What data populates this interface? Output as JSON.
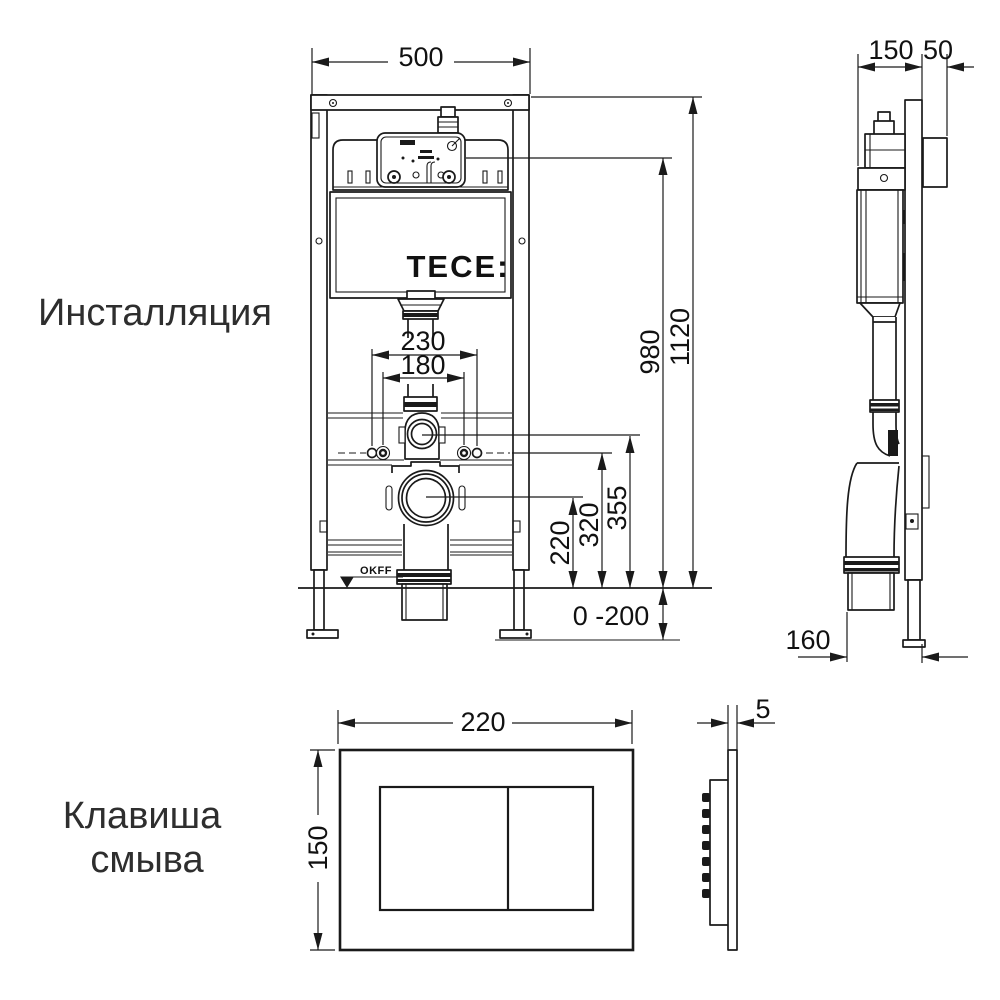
{
  "colors": {
    "background": "#ffffff",
    "line": "#1a1a1a",
    "label_text": "#2e2e2e"
  },
  "labels": {
    "installation": "Инсталляция",
    "flush_plate_line1": "Клавиша",
    "flush_plate_line2": "смыва"
  },
  "front_view": {
    "brand_logo": "TECE:",
    "floor_level_mark": "OKFF",
    "dimensions": {
      "frame_width": "500",
      "spigot_spacing": "230",
      "stud_spacing": "180",
      "drain_outlet_height": "220",
      "fixing_stud_height": "320",
      "flush_bend_height": "355",
      "service_opening_height": "980",
      "frame_height": "1120",
      "foot_adjustment_range": "0 -200"
    }
  },
  "side_view": {
    "dimensions": {
      "frame_depth": "150",
      "front_offset": "50",
      "drain_offset": "160"
    }
  },
  "flush_plate": {
    "front": {
      "width": "220",
      "height": "150"
    },
    "side": {
      "thickness": "5"
    }
  }
}
